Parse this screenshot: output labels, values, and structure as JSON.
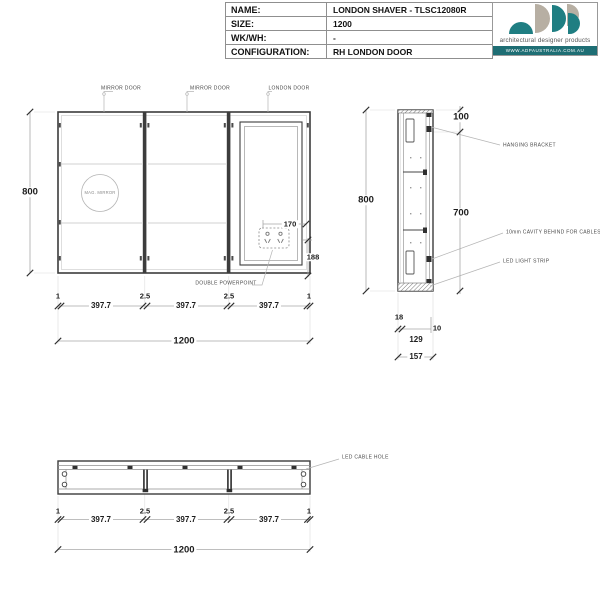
{
  "title_block": {
    "rows": [
      {
        "label": "NAME:",
        "value": "LONDON SHAVER - TLSC12080R"
      },
      {
        "label": "SIZE:",
        "value": "1200"
      },
      {
        "label": "WK/WH:",
        "value": "-"
      },
      {
        "label": "CONFIGURATION:",
        "value": "RH LONDON DOOR"
      }
    ]
  },
  "logo": {
    "tagline": "architectural designer products",
    "website": "WWW.ADPAUSTRALIA.COM.AU",
    "teal": "#1f7e82",
    "grey": "#b7afa3",
    "band": "#1e6e74"
  },
  "front_view": {
    "door_labels": [
      "MIRROR DOOR",
      "MIRROR DOOR",
      "LONDON DOOR"
    ],
    "mag_mirror_label": "MAG. MIRROR",
    "powerpoint_label": "DOUBLE POWERPOINT",
    "height": "800",
    "powerpoint_offset_h": "170",
    "powerpoint_offset_v": "188",
    "bottom": {
      "gaps": [
        "1",
        "2.5",
        "2.5",
        "1"
      ],
      "segments": [
        "397.7",
        "397.7",
        "397.7"
      ],
      "total": "1200"
    }
  },
  "side_view": {
    "height": "800",
    "top_offset": "100",
    "body_height": "700",
    "labels": {
      "bracket": "HANGING BRACKET",
      "cavity": "10mm CAVITY BEHIND FOR CABLES",
      "led": "LED LIGHT STRIP"
    },
    "depth": {
      "door": "18",
      "gap": "10",
      "body": "129",
      "total": "157"
    }
  },
  "plan_view": {
    "cable_label": "LED CABLE HOLE",
    "bottom": {
      "gaps": [
        "1",
        "2.5",
        "2.5",
        "1"
      ],
      "segments": [
        "397.7",
        "397.7",
        "397.7"
      ],
      "total": "1200"
    }
  }
}
